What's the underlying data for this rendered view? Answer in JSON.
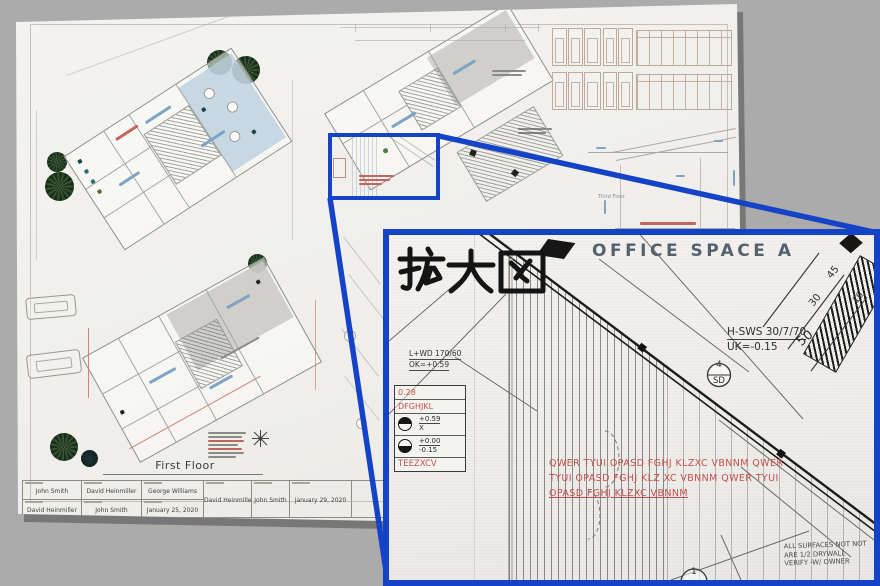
{
  "colors": {
    "callout_blue": "#1443c8",
    "annotation_red": "#c4504d",
    "paper": "#f2f0ed",
    "background": "#ababab",
    "room_label_color": "#55616e"
  },
  "sheet": {
    "first_floor_label": "First Floor",
    "section_label": "Third Floor",
    "title_block": {
      "cells": [
        {
          "top": "John Smith",
          "bottom": "David Heinmiller"
        },
        {
          "top": "David Heinmiller",
          "bottom": "John Smith"
        },
        {
          "top": "George Williams",
          "bottom": "January 25, 2020"
        }
      ],
      "singles": [
        "David Heinmiller",
        "John Smith",
        "January 29, 2020"
      ],
      "watermark": "Image"
    }
  },
  "inset": {
    "title": "拡大図",
    "room_label": "OFFICE SPACE A",
    "wall_tag_line1": "H-SWS 30/7/70",
    "wall_tag_line2": "UK=-0.15",
    "dim_50": "50",
    "dims": {
      "d45": "45",
      "d30": "30",
      "d10": "10"
    },
    "lintel_line1": "L+WD 170/60",
    "lintel_line2": "OK=+0.59",
    "legend": {
      "r1": "0.28",
      "r2": "DFGHJKL",
      "sym1_top": "+0.59",
      "sym1_bottom": "X",
      "sym2_top": "+0.00",
      "sym2_bottom": "-0.15",
      "r5": "TEEZXCV"
    },
    "red_note": [
      "QWER TYUI OPASD FGHJ KLZXC VBNNM QWER",
      "TYUI OPASD FGHJ KLZ XC VBNNM QWER TYUI",
      "OPASD FGHJ KLZXC VBNNM"
    ],
    "surface_note": [
      "ALL SURFACES NOT NOT",
      "ARE 1/2 DRYWALL",
      "VERIFY -W/ OWNER"
    ],
    "bubble_sd": {
      "num": "4",
      "tag": "SD"
    },
    "bubble_gw": {
      "num": "1",
      "tag": "GW"
    }
  }
}
